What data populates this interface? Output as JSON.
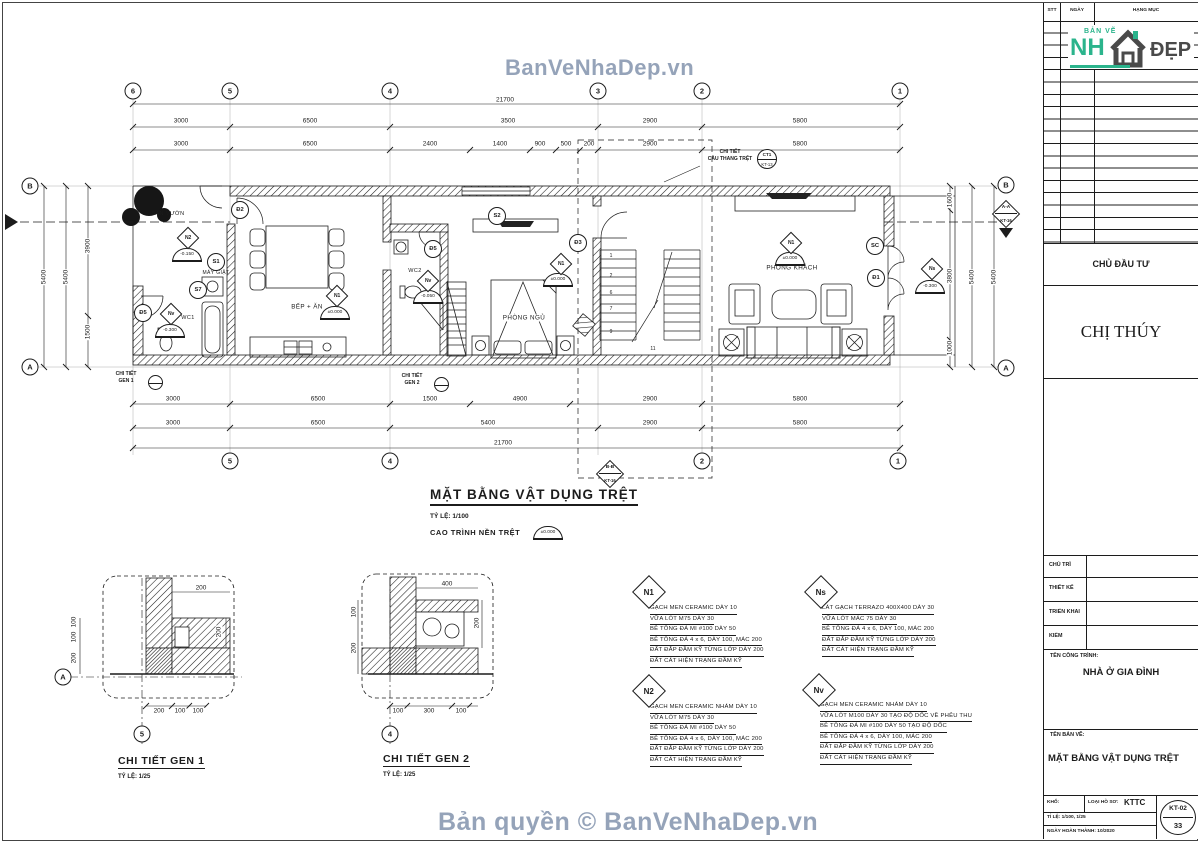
{
  "watermarks": {
    "top": "BanVeNhaDep.vn",
    "bottom": "Bản quyền © BanVeNhaDep.vn"
  },
  "revision_table": {
    "headers": [
      "STT",
      "NGÀY",
      "HẠNG MỤC"
    ]
  },
  "logo": {
    "top": "BẢN VẼ",
    "main": "NH",
    "suffix": "ĐẸP"
  },
  "title_block": {
    "investor_label": "CHỦ ĐẦU TƯ",
    "investor_name": "CHỊ THÚY",
    "roles": [
      "CHỦ TRÌ",
      "THIẾT KẾ",
      "TRIỂN KHAI",
      "KIỂM"
    ],
    "project_label": "TÊN CÔNG TRÌNH:",
    "project_name": "NHÀ Ở GIA ĐÌNH",
    "drawing_label": "TÊN BẢN VẼ:",
    "drawing_name": "MẶT BẰNG VẬT DỤNG TRỆT",
    "paper_label": "KHỔ:",
    "dossier_label": "LOẠI HỒ SƠ:",
    "dossier_value": "KTTC",
    "scale_line": "TỈ LỆ: 1/100, 1/25",
    "date_line": "NGÀY HOÀN THÀNH: 10/2020",
    "sheet_code": "KT-02",
    "sheet_no": "33"
  },
  "plan": {
    "title": "MẶT BẰNG VẬT DỤNG TRỆT",
    "scale": "TỶ LỆ: 1/100",
    "floor_level_label": "CAO TRÌNH NỀN TRỆT",
    "floor_level_value": "±0.000",
    "grid_top": [
      "6",
      "5",
      "4",
      "3",
      "2",
      "1"
    ],
    "grid_bottom": [
      "5",
      "4",
      "2",
      "1"
    ],
    "grid_left": [
      "B",
      "A"
    ],
    "grid_right": [
      "B",
      "A"
    ],
    "section_a": {
      "name": "A-A",
      "sheet": "KT-16"
    },
    "section_b": {
      "name": "B-B",
      "sheet": "KT-16"
    },
    "stair_callout": {
      "line1": "CHI TIẾT",
      "line2": "CẦU THANG TRỆT",
      "ref_top": "CT1",
      "ref_bottom": "KT-13"
    },
    "gen1_callout": {
      "line1": "CHI TIẾT",
      "line2": "GEN 1"
    },
    "gen2_callout": {
      "line1": "CHI TIẾT",
      "line2": "GEN 2"
    },
    "rooms": [
      "SÂN VƯỜN",
      "MÁY GIẶT",
      "WC1",
      "BẾP + ĂN",
      "WC2",
      "PHÒNG NGỦ",
      "PHÒNG KHÁCH"
    ],
    "door_tags": [
      "Đ2",
      "S1",
      "S7",
      "Đ5",
      "S2",
      "Đ5",
      "Đ3",
      "SC",
      "Đ1"
    ],
    "finish_marks": [
      {
        "code": "N2",
        "level": "-0.150"
      },
      {
        "code": "Nv",
        "level": "-0.300"
      },
      {
        "code": "N1",
        "level": "±0.000"
      },
      {
        "code": "Nv",
        "level": "-0.050"
      },
      {
        "code": "N1",
        "level": "±0.000"
      },
      {
        "code": "N1",
        "level": "±0.000"
      },
      {
        "code": "Ns",
        "level": "-0.300"
      }
    ],
    "stair_numbers": [
      "1",
      "2",
      "6",
      "7",
      "9",
      "11"
    ],
    "dims": {
      "total_top": "21700",
      "total_bottom": "21700",
      "top_mid": [
        "3000",
        "6500",
        "3500",
        "2900",
        "5800"
      ],
      "top_inner": [
        "3000",
        "6500",
        "2400",
        "1400",
        "900",
        "500",
        "200",
        "2900",
        "5800"
      ],
      "bottom_inner": [
        "3000",
        "6500",
        "1500",
        "4900",
        "2900",
        "5800"
      ],
      "bottom_mid": [
        "3000",
        "6500",
        "5400",
        "2900",
        "5800"
      ],
      "left": [
        "5400",
        "5400",
        "3900",
        "1500"
      ],
      "right": [
        "1600",
        "3800",
        "1000",
        "5400",
        "5400"
      ]
    }
  },
  "details": [
    {
      "title": "CHI TIẾT GEN 1",
      "scale": "TỶ LỆ: 1/25",
      "axis_bottom": "5",
      "axis_left": "A",
      "dim_top": "200",
      "dim_right": "200",
      "dims_bottom": [
        "200",
        "100",
        "100"
      ],
      "dims_left": [
        "100",
        "100",
        "200"
      ]
    },
    {
      "title": "CHI TIẾT GEN 2",
      "scale": "TỶ LỆ: 1/25",
      "axis_bottom": "4",
      "dim_top": "400",
      "dim_right": "200",
      "dims_bottom": [
        "100",
        "300",
        "100"
      ],
      "dims_left": [
        "100",
        "200"
      ]
    }
  ],
  "notes": [
    {
      "code": "N1",
      "lines": [
        "GẠCH MEN CERAMIC DÀY 10",
        "VỮA LÓT M75 DÀY 30",
        "BÊ TÔNG ĐÁ MI #100 DÀY 50",
        "BÊ TÔNG ĐÁ 4 x 6, DÀY 100, MÁC 200",
        "ĐẤT ĐẮP ĐẦM KỸ TỪNG LỚP DÀY 200",
        "ĐẤT CÁT HIỆN TRẠNG ĐẦM KỸ"
      ]
    },
    {
      "code": "Ns",
      "lines": [
        "LÁT GẠCH TERRAZO 400X400 DÀY 30",
        "VỮA LÓT MÁC 75 DÀY 30",
        "BÊ TÔNG ĐÁ 4 x 6, DÀY 100, MÁC 200",
        "ĐẤT ĐẮP ĐẦM KỸ TỪNG LỚP DÀY 200",
        "ĐẤT CÁT HIỆN TRẠNG ĐẦM KỸ"
      ]
    },
    {
      "code": "N2",
      "lines": [
        "GẠCH MEN CERAMIC NHÁM DÀY 10",
        "VỮA LÓT M75 DÀY 30",
        "BÊ TÔNG ĐÁ MI #100 DÀY 50",
        "BÊ TÔNG ĐÁ 4 x 6, DÀY 100, MÁC 200",
        "ĐẤT ĐẮP ĐẦM KỸ TỪNG LỚP DÀY 200",
        "ĐẤT CÁT HIỆN TRẠNG ĐẦM KỸ"
      ]
    },
    {
      "code": "Nv",
      "lines": [
        "GẠCH MEN CERAMIC NHÁM DÀY 10",
        "VỮA LÓT M100 DÀY 30 TẠO ĐỘ DỐC VỀ PHỄU THU",
        "BÊ TÔNG ĐÁ MI #100 DÀY 50 TẠO ĐỘ DỐC",
        "BÊ TÔNG ĐÁ 4 x 6, DÀY 100, MÁC 200",
        "ĐẤT ĐẮP ĐẦM KỸ TỪNG LỚP DÀY 200",
        "ĐẤT CÁT HIỆN TRẠNG ĐẦM KỸ"
      ]
    }
  ],
  "colors": {
    "ink": "#1c1c1c",
    "watermark": "#8a9ab2",
    "logo_green": "#2bb48c",
    "logo_dark": "#4a4a4a"
  }
}
